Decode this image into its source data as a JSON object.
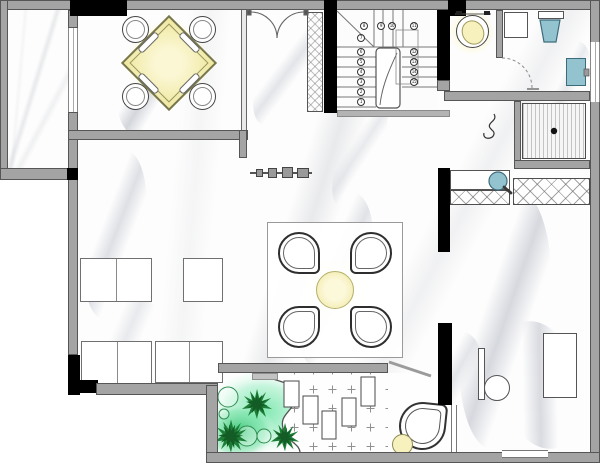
{
  "colors": {
    "wall-fill": "#a4a4a4",
    "wall-stroke": "#565656",
    "wall-black": "#000000",
    "floor": "#fdfdfd",
    "marble-vein": "#c9ccd4",
    "accent-yellow": "#f6f1bd",
    "accent-yellow-deep": "#efe79e",
    "fixture-blue": "#93c3cf",
    "fixture-blue-stroke": "#3d6b7c",
    "plant-green": "#1d7c35",
    "plant-green-dark": "#135c26",
    "garden-glow": "#45d183",
    "tile-cross": "#909090",
    "stripe-gray": "#c4c4c4",
    "line-dark": "#3a3a3a",
    "line-mid": "#777777"
  },
  "stairs": {
    "left_flight": [
      "7",
      "6",
      "5",
      "4",
      "3",
      "2",
      "1"
    ],
    "top_flight": [
      "8",
      "9",
      "10",
      "11"
    ],
    "right_flight": [
      "12",
      "13",
      "14",
      "15"
    ]
  }
}
